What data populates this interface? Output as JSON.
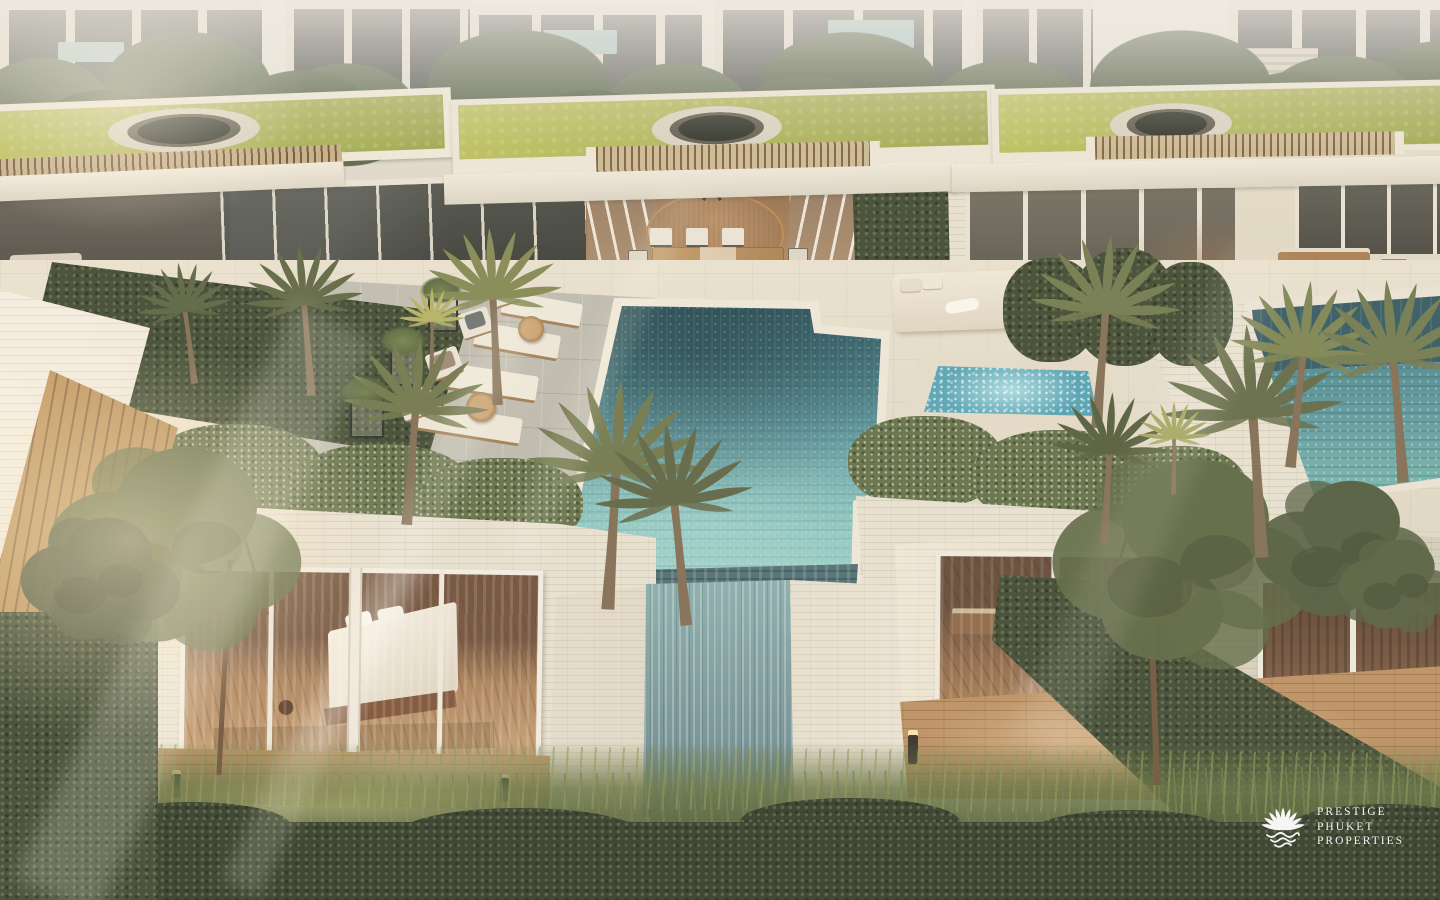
{
  "watermark": {
    "lines": [
      "PRESTIGE",
      "PHUKET",
      "PROPERTIES"
    ]
  },
  "palette": {
    "pool_deep": "#25505c",
    "pool_mid": "#4f939c",
    "pool_light": "#8fcdc6",
    "deck_cream": "#e8e1d0",
    "stone_white": "#e7e1d2",
    "grass_roof": "#a9b253",
    "tree_olive": "#5c6a48",
    "hedge_dark": "#39452e",
    "foliage_shadow": "#2d3725",
    "wood_warm": "#b98e5f",
    "interior_wood": "#a97e57",
    "jacuzzi_water": "#5fb0c2",
    "neighbor_pool": "#4a8a92",
    "background_haze": "#eceae2",
    "watermark_white": "#ffffff"
  }
}
